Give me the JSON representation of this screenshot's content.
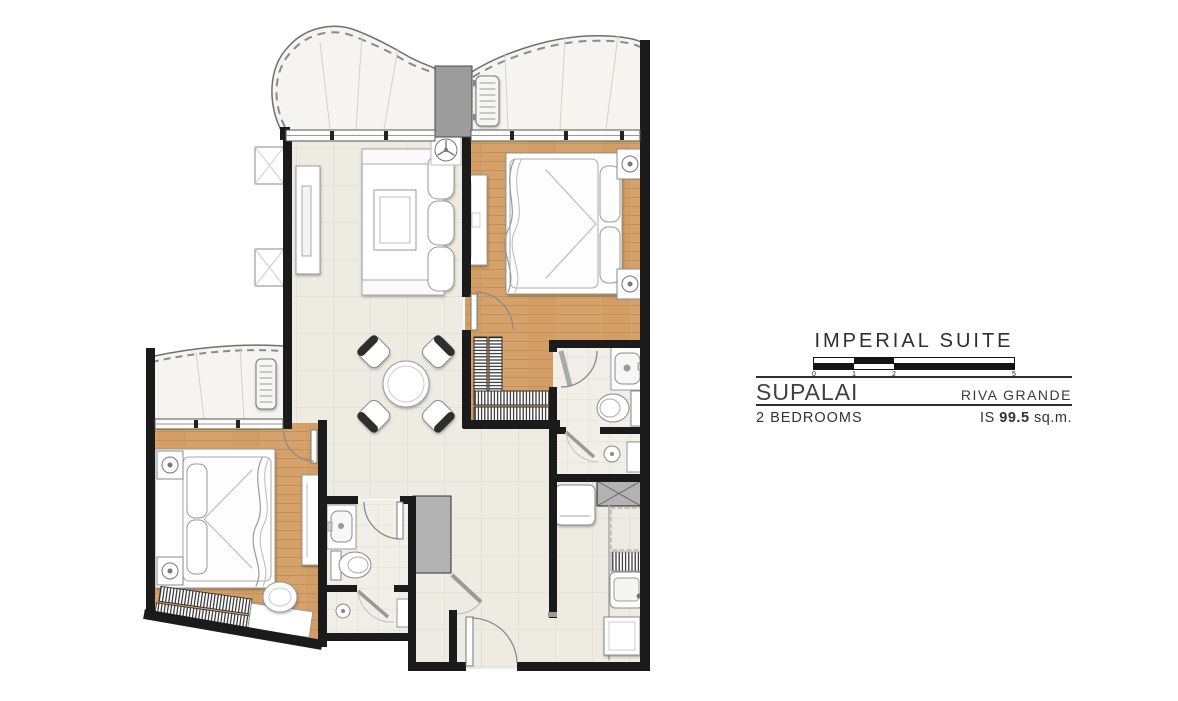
{
  "panel": {
    "title": "IMPERIAL SUITE",
    "developer": "SUPALAI",
    "project": "RIVA GRANDE",
    "unit_type": "2 BEDROOMS",
    "area_code": "IS",
    "area_value": "99.5",
    "area_unit": "sq.m.",
    "scale_ticks": [
      "0",
      "1",
      "2",
      "5"
    ]
  },
  "colors": {
    "wall": "#1b1b1b",
    "wood-floor": "#d6a26b",
    "tile-floor": "#edebe2",
    "bath-floor": "#f1efe7",
    "balcony-floor": "#f5f4f1",
    "fixture-gray": "#b3b3b3",
    "text": "#3c3c3c"
  }
}
